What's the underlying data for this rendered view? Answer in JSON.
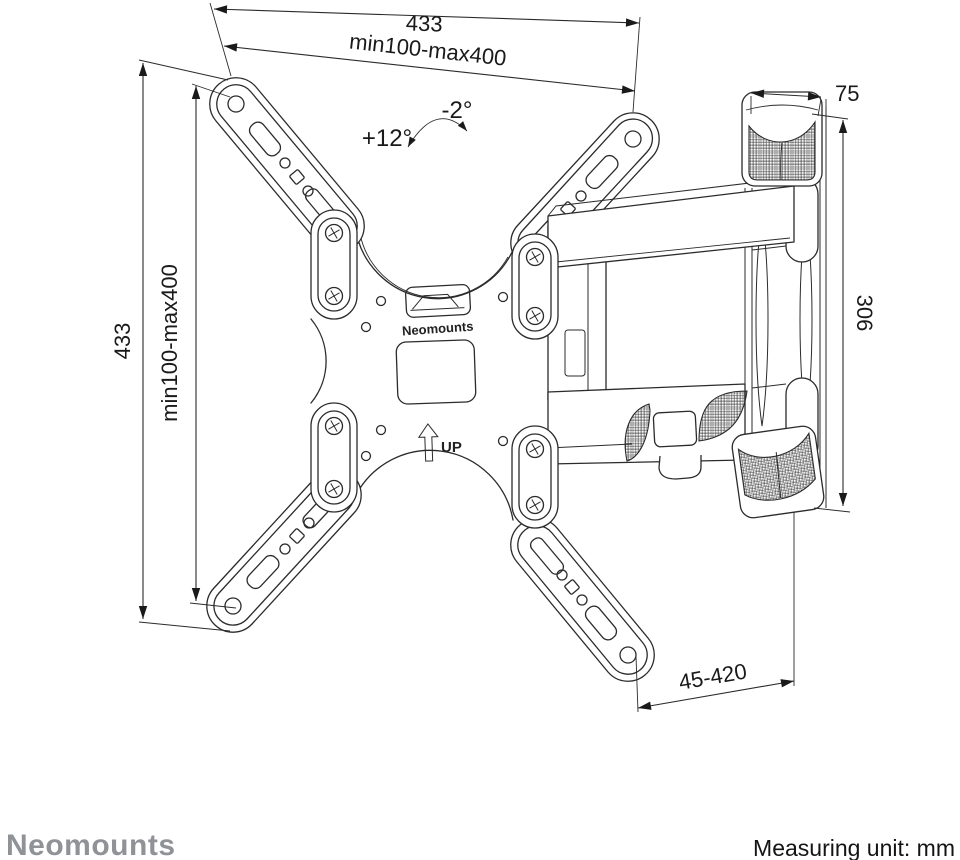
{
  "colors": {
    "line": "#2b2b2b",
    "text": "#1a1a1a",
    "brand_gray": "#8f9296",
    "background": "#ffffff"
  },
  "plate": {
    "brand_label": "Neomounts",
    "up_label": "UP"
  },
  "dimensions": {
    "top_total": "433",
    "top_vesa": "min100-max400",
    "left_total": "433",
    "left_vesa": "min100-max400",
    "wallplate_width": "75",
    "wallplate_height": "306",
    "extension_range": "45-420",
    "tilt_up": "+12°",
    "tilt_down": "-2°"
  },
  "footer": {
    "brand": "Neomounts",
    "measuring_label": "Measuring unit: mm"
  }
}
